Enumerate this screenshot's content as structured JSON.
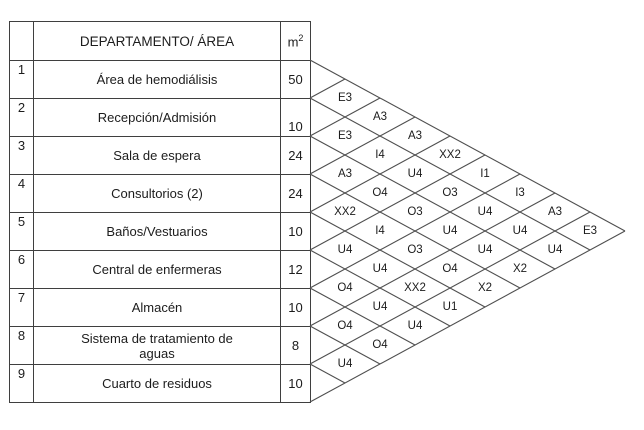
{
  "table": {
    "header": {
      "num_label": "",
      "department_label": "DEPARTAMENTO/ ÁREA",
      "area_unit_base": "m",
      "area_unit_exponent": "2"
    },
    "rows": [
      {
        "num": "1",
        "name": "Área de hemodiálisis",
        "area": "50"
      },
      {
        "num": "2",
        "name": "Recepción/Admisión",
        "area": "10"
      },
      {
        "num": "3",
        "name": "Sala de espera",
        "area": "24"
      },
      {
        "num": "4",
        "name": "Consultorios (2)",
        "area": "24"
      },
      {
        "num": "5",
        "name": "Baños/Vestuarios",
        "area": "10"
      },
      {
        "num": "6",
        "name": "Central de enfermeras",
        "area": "12"
      },
      {
        "num": "7",
        "name": "Almacén",
        "area": "10"
      },
      {
        "num": "8",
        "name": "Sistema de tratamiento de aguas",
        "area": "8"
      },
      {
        "num": "9",
        "name": "Cuarto de residuos",
        "area": "10"
      }
    ]
  },
  "matrix": {
    "description": "Relationship chart codes between department pairs (a-b)",
    "cells": [
      {
        "a": 1,
        "b": 2,
        "code": "E3"
      },
      {
        "a": 1,
        "b": 3,
        "code": "A3"
      },
      {
        "a": 1,
        "b": 4,
        "code": "A3"
      },
      {
        "a": 1,
        "b": 5,
        "code": "XX2"
      },
      {
        "a": 1,
        "b": 6,
        "code": "I1"
      },
      {
        "a": 1,
        "b": 7,
        "code": "I3"
      },
      {
        "a": 1,
        "b": 8,
        "code": "A3"
      },
      {
        "a": 1,
        "b": 9,
        "code": "E3"
      },
      {
        "a": 2,
        "b": 3,
        "code": "E3"
      },
      {
        "a": 2,
        "b": 4,
        "code": "I4"
      },
      {
        "a": 2,
        "b": 5,
        "code": "U4"
      },
      {
        "a": 2,
        "b": 6,
        "code": "O3"
      },
      {
        "a": 2,
        "b": 7,
        "code": "U4"
      },
      {
        "a": 2,
        "b": 8,
        "code": "U4"
      },
      {
        "a": 2,
        "b": 9,
        "code": "U4"
      },
      {
        "a": 3,
        "b": 4,
        "code": "A3"
      },
      {
        "a": 3,
        "b": 5,
        "code": "O4"
      },
      {
        "a": 3,
        "b": 6,
        "code": "O3"
      },
      {
        "a": 3,
        "b": 7,
        "code": "U4"
      },
      {
        "a": 3,
        "b": 8,
        "code": "U4"
      },
      {
        "a": 3,
        "b": 9,
        "code": "X2"
      },
      {
        "a": 4,
        "b": 5,
        "code": "XX2"
      },
      {
        "a": 4,
        "b": 6,
        "code": "I4"
      },
      {
        "a": 4,
        "b": 7,
        "code": "O3"
      },
      {
        "a": 4,
        "b": 8,
        "code": "O4"
      },
      {
        "a": 4,
        "b": 9,
        "code": "X2"
      },
      {
        "a": 5,
        "b": 6,
        "code": "U4"
      },
      {
        "a": 5,
        "b": 7,
        "code": "U4"
      },
      {
        "a": 5,
        "b": 8,
        "code": "XX2"
      },
      {
        "a": 5,
        "b": 9,
        "code": "U1"
      },
      {
        "a": 6,
        "b": 7,
        "code": "O4"
      },
      {
        "a": 6,
        "b": 8,
        "code": "U4"
      },
      {
        "a": 6,
        "b": 9,
        "code": "U4"
      },
      {
        "a": 7,
        "b": 8,
        "code": "O4"
      },
      {
        "a": 7,
        "b": 9,
        "code": "O4"
      },
      {
        "a": 8,
        "b": 9,
        "code": "U4"
      }
    ]
  },
  "colors": {
    "background": "#ffffff",
    "table_border": "#3f3f3f",
    "lattice_line": "#4f4f4f",
    "text": "#1c1c1c"
  }
}
